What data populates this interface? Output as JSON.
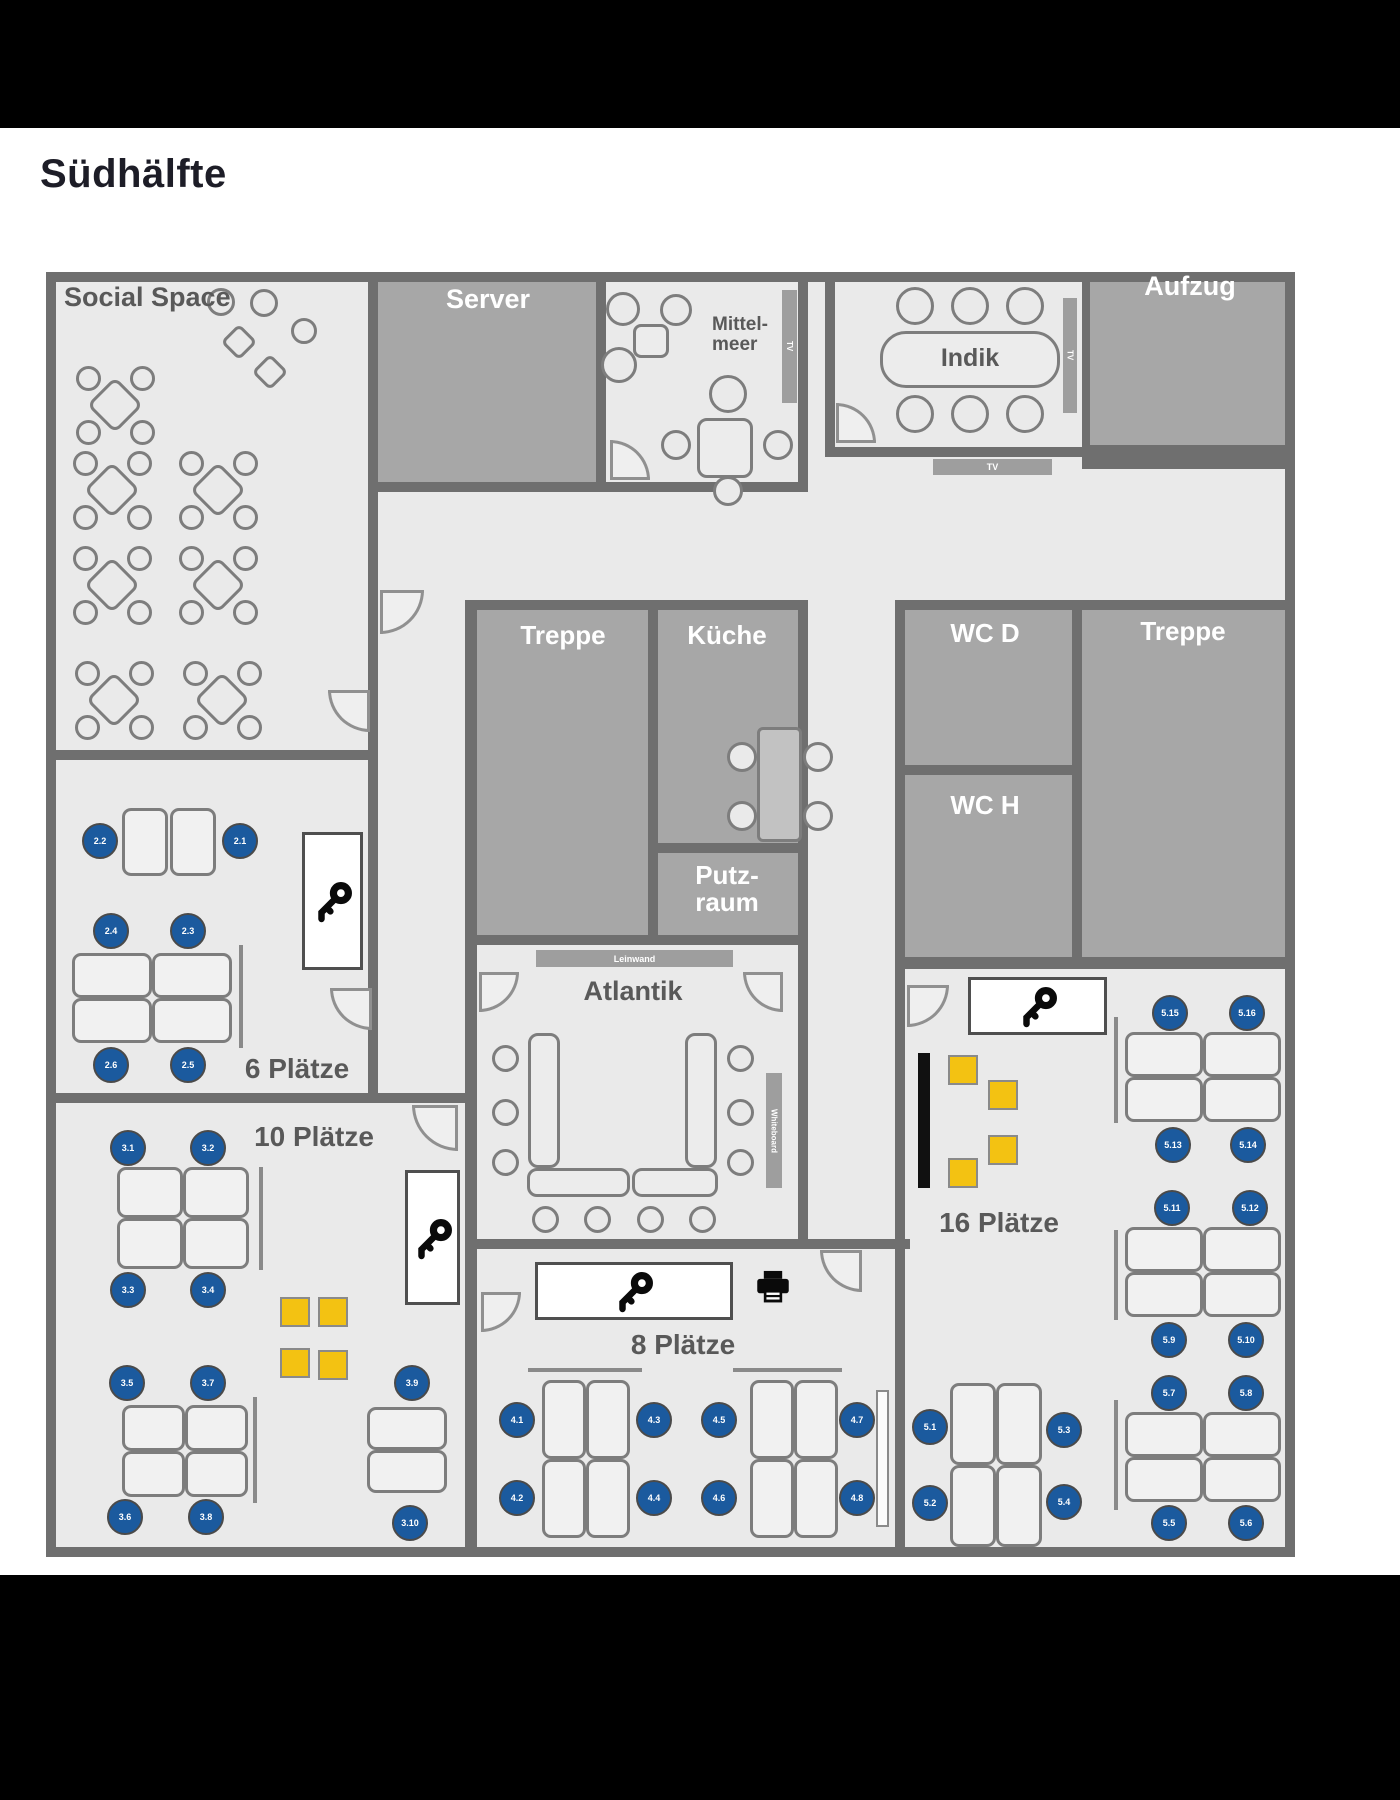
{
  "title": "Südhälfte",
  "colors": {
    "letterbox": "#000000",
    "floor": "#eaeaea",
    "wall": "#6f6f6f",
    "dark_room": "#a7a7a7",
    "seat_blue": "#1b5a9e",
    "locker_yellow": "#f3c212",
    "label_gray": "#595959",
    "label_white": "#ffffff"
  },
  "plan": {
    "rooms": [
      {
        "n": "floor",
        "x": 46,
        "y": 272,
        "w": 1249,
        "h": 1285,
        "f": "floor"
      },
      {
        "n": "server",
        "x": 378,
        "y": 282,
        "w": 218,
        "h": 200
      },
      {
        "n": "aufzug",
        "x": 1090,
        "y": 282,
        "w": 205,
        "h": 170
      },
      {
        "n": "treppe-mitte",
        "x": 477,
        "y": 610,
        "w": 171,
        "h": 330
      },
      {
        "n": "kueche",
        "x": 658,
        "y": 610,
        "w": 140,
        "h": 233
      },
      {
        "n": "putzraum",
        "x": 658,
        "y": 853,
        "w": 140,
        "h": 85
      },
      {
        "n": "wc-d",
        "x": 905,
        "y": 610,
        "w": 167,
        "h": 155
      },
      {
        "n": "wc-h",
        "x": 905,
        "y": 775,
        "w": 167,
        "h": 182
      },
      {
        "n": "treppe-rechts",
        "x": 1082,
        "y": 610,
        "w": 213,
        "h": 347
      }
    ],
    "walls": [
      [
        46,
        272,
        1249,
        10
      ],
      [
        46,
        272,
        10,
        1285
      ],
      [
        1285,
        272,
        10,
        1285
      ],
      [
        46,
        1547,
        1249,
        10
      ],
      [
        368,
        272,
        10,
        828
      ],
      [
        46,
        750,
        330,
        10
      ],
      [
        596,
        272,
        10,
        218
      ],
      [
        368,
        482,
        440,
        10
      ],
      [
        798,
        272,
        10,
        218
      ],
      [
        825,
        272,
        10,
        183
      ],
      [
        825,
        447,
        265,
        10
      ],
      [
        1082,
        272,
        8,
        183
      ],
      [
        1082,
        445,
        213,
        24
      ],
      [
        465,
        600,
        343,
        10
      ],
      [
        465,
        600,
        12,
        957
      ],
      [
        648,
        610,
        10,
        330
      ],
      [
        798,
        600,
        10,
        649
      ],
      [
        656,
        843,
        142,
        10
      ],
      [
        465,
        935,
        343,
        10
      ],
      [
        465,
        1239,
        445,
        10
      ],
      [
        895,
        600,
        10,
        957
      ],
      [
        895,
        600,
        400,
        10
      ],
      [
        903,
        765,
        170,
        10
      ],
      [
        1072,
        600,
        10,
        357
      ],
      [
        895,
        957,
        400,
        12
      ],
      [
        46,
        1093,
        424,
        10
      ]
    ],
    "doors": [
      {
        "x": 380,
        "y": 590,
        "s": 44,
        "c": "br"
      },
      {
        "x": 610,
        "y": 440,
        "s": 40,
        "c": "tr"
      },
      {
        "x": 836,
        "y": 403,
        "s": 40,
        "c": "tr"
      },
      {
        "x": 328,
        "y": 690,
        "s": 42,
        "c": "bl"
      },
      {
        "x": 330,
        "y": 988,
        "s": 42,
        "c": "bl"
      },
      {
        "x": 412,
        "y": 1105,
        "s": 46,
        "c": "bl"
      },
      {
        "x": 479,
        "y": 972,
        "s": 40,
        "c": "br"
      },
      {
        "x": 743,
        "y": 972,
        "s": 40,
        "c": "bl"
      },
      {
        "x": 481,
        "y": 1292,
        "s": 40,
        "c": "br"
      },
      {
        "x": 820,
        "y": 1250,
        "s": 42,
        "c": "bl"
      },
      {
        "x": 907,
        "y": 985,
        "s": 42,
        "c": "br"
      }
    ],
    "texts": [
      {
        "n": "label-social-space",
        "t": "Social Space",
        "x": 64,
        "y": 283,
        "s": 27
      },
      {
        "n": "label-server",
        "t": "Server",
        "cx": 488,
        "y": 285,
        "s": 27,
        "w": true
      },
      {
        "n": "label-mittelmeer",
        "t": "Mittel-\nmeer",
        "cx": 740,
        "y": 315,
        "s": 19
      },
      {
        "n": "label-indik",
        "t": "Indik",
        "cx": 970,
        "y": 345,
        "s": 25
      },
      {
        "n": "label-aufzug",
        "t": "Aufzug",
        "cx": 1190,
        "y": 272,
        "s": 27,
        "w": true
      },
      {
        "n": "label-treppe-mitte",
        "t": "Treppe",
        "cx": 563,
        "y": 622,
        "s": 26,
        "w": true
      },
      {
        "n": "label-kueche",
        "t": "Küche",
        "cx": 727,
        "y": 622,
        "s": 26,
        "w": true
      },
      {
        "n": "label-putzraum",
        "t": "Putz-\nraum",
        "cx": 727,
        "y": 862,
        "s": 26,
        "w": true
      },
      {
        "n": "label-wc-d",
        "t": "WC D",
        "cx": 985,
        "y": 620,
        "s": 26,
        "w": true
      },
      {
        "n": "label-wc-h",
        "t": "WC H",
        "cx": 985,
        "y": 792,
        "s": 26,
        "w": true
      },
      {
        "n": "label-treppe-rechts",
        "t": "Treppe",
        "cx": 1183,
        "y": 618,
        "s": 26,
        "w": true
      },
      {
        "n": "label-atlantik",
        "t": "Atlantik",
        "cx": 633,
        "y": 977,
        "s": 27
      },
      {
        "n": "label-6-plaetze",
        "t": "6 Plätze",
        "cx": 297,
        "y": 1054,
        "s": 28
      },
      {
        "n": "label-10-plaetze",
        "t": "10 Plätze",
        "cx": 314,
        "y": 1122,
        "s": 28
      },
      {
        "n": "label-8-plaetze",
        "t": "8 Plätze",
        "cx": 683,
        "y": 1330,
        "s": 28
      },
      {
        "n": "label-16-plaetze",
        "t": "16 Plätze",
        "cx": 999,
        "y": 1208,
        "s": 28
      }
    ],
    "signs": [
      {
        "n": "sign-leinwand",
        "t": "Leinwand",
        "x": 536,
        "y": 950,
        "w": 197,
        "h": 17
      },
      {
        "n": "sign-whiteboard",
        "t": "Whiteboard",
        "x": 766,
        "y": 1073,
        "w": 16,
        "h": 115,
        "rot": true
      },
      {
        "n": "sign-tv-mittelmeer",
        "t": "TV",
        "x": 782,
        "y": 290,
        "w": 15,
        "h": 113,
        "rot": true
      },
      {
        "n": "sign-tv-indik",
        "t": "TV",
        "x": 1063,
        "y": 298,
        "w": 14,
        "h": 115,
        "rot": true
      },
      {
        "n": "sign-tv-wand",
        "t": "TV",
        "x": 933,
        "y": 459,
        "w": 119,
        "h": 16
      }
    ],
    "round_tables": [
      {
        "cx": 115,
        "cy": 405
      },
      {
        "cx": 112,
        "cy": 490
      },
      {
        "cx": 218,
        "cy": 490
      },
      {
        "cx": 112,
        "cy": 585
      },
      {
        "cx": 218,
        "cy": 585
      },
      {
        "cx": 114,
        "cy": 700
      },
      {
        "cx": 222,
        "cy": 700
      }
    ],
    "social_shapes": [
      {
        "k": "circle",
        "cx": 221,
        "cy": 302,
        "d": 28
      },
      {
        "k": "circle",
        "cx": 264,
        "cy": 303,
        "d": 28
      },
      {
        "k": "diamond",
        "cx": 239,
        "cy": 342,
        "d": 26
      },
      {
        "k": "circle",
        "cx": 304,
        "cy": 331,
        "d": 26
      },
      {
        "k": "diamond",
        "cx": 270,
        "cy": 372,
        "d": 26
      }
    ],
    "tables": [
      {
        "x": 880,
        "y": 331,
        "w": 180,
        "h": 57,
        "r": 26
      },
      {
        "x": 697,
        "y": 418,
        "w": 56,
        "h": 60,
        "r": 10
      },
      {
        "x": 633,
        "y": 324,
        "w": 36,
        "h": 34,
        "r": 8
      },
      {
        "x": 757,
        "y": 727,
        "w": 45,
        "h": 115,
        "r": 6,
        "dark": true
      },
      {
        "x": 528,
        "y": 1033,
        "w": 32,
        "h": 135,
        "r": 10
      },
      {
        "x": 685,
        "y": 1033,
        "w": 32,
        "h": 135,
        "r": 10
      },
      {
        "x": 527,
        "y": 1168,
        "w": 103,
        "h": 29,
        "r": 10
      },
      {
        "x": 632,
        "y": 1168,
        "w": 86,
        "h": 29,
        "r": 10
      }
    ],
    "chairs": [
      {
        "cx": 623,
        "cy": 309,
        "d": 34
      },
      {
        "cx": 676,
        "cy": 310,
        "d": 32
      },
      {
        "cx": 619,
        "cy": 365,
        "d": 36
      },
      {
        "cx": 728,
        "cy": 394,
        "d": 38
      },
      {
        "cx": 676,
        "cy": 445,
        "d": 30
      },
      {
        "cx": 778,
        "cy": 445,
        "d": 30
      },
      {
        "cx": 728,
        "cy": 491,
        "d": 30
      },
      {
        "cx": 915,
        "cy": 306,
        "d": 38
      },
      {
        "cx": 970,
        "cy": 306,
        "d": 38
      },
      {
        "cx": 1025,
        "cy": 306,
        "d": 38
      },
      {
        "cx": 915,
        "cy": 414,
        "d": 38
      },
      {
        "cx": 970,
        "cy": 414,
        "d": 38
      },
      {
        "cx": 1025,
        "cy": 414,
        "d": 38
      },
      {
        "cx": 742,
        "cy": 757,
        "d": 30
      },
      {
        "cx": 742,
        "cy": 816,
        "d": 30
      },
      {
        "cx": 818,
        "cy": 757,
        "d": 30
      },
      {
        "cx": 818,
        "cy": 816,
        "d": 30
      },
      {
        "cx": 505,
        "cy": 1058,
        "d": 27
      },
      {
        "cx": 505,
        "cy": 1112,
        "d": 27
      },
      {
        "cx": 505,
        "cy": 1162,
        "d": 27
      },
      {
        "cx": 740,
        "cy": 1058,
        "d": 27
      },
      {
        "cx": 740,
        "cy": 1112,
        "d": 27
      },
      {
        "cx": 740,
        "cy": 1162,
        "d": 27
      },
      {
        "cx": 545,
        "cy": 1219,
        "d": 27
      },
      {
        "cx": 597,
        "cy": 1219,
        "d": 27
      },
      {
        "cx": 650,
        "cy": 1219,
        "d": 27
      },
      {
        "cx": 702,
        "cy": 1219,
        "d": 27
      }
    ],
    "desks": [
      [
        122,
        808,
        46,
        68
      ],
      [
        170,
        808,
        46,
        68
      ],
      [
        72,
        953,
        80,
        45
      ],
      [
        152,
        953,
        80,
        45
      ],
      [
        72,
        998,
        80,
        45
      ],
      [
        152,
        998,
        80,
        45
      ],
      [
        117,
        1167,
        66,
        51
      ],
      [
        183,
        1167,
        66,
        51
      ],
      [
        117,
        1218,
        66,
        51
      ],
      [
        183,
        1218,
        66,
        51
      ],
      [
        122,
        1405,
        63,
        46
      ],
      [
        185,
        1405,
        63,
        46
      ],
      [
        122,
        1451,
        63,
        46
      ],
      [
        185,
        1451,
        63,
        46
      ],
      [
        367,
        1407,
        80,
        43
      ],
      [
        367,
        1450,
        80,
        43
      ],
      [
        542,
        1380,
        44,
        79
      ],
      [
        586,
        1380,
        44,
        79
      ],
      [
        542,
        1459,
        44,
        79
      ],
      [
        586,
        1459,
        44,
        79
      ],
      [
        750,
        1380,
        44,
        79
      ],
      [
        794,
        1380,
        44,
        79
      ],
      [
        750,
        1459,
        44,
        79
      ],
      [
        794,
        1459,
        44,
        79
      ],
      [
        950,
        1383,
        46,
        82
      ],
      [
        996,
        1383,
        46,
        82
      ],
      [
        950,
        1465,
        46,
        82
      ],
      [
        996,
        1465,
        46,
        82
      ],
      [
        1125,
        1032,
        78,
        45
      ],
      [
        1203,
        1032,
        78,
        45
      ],
      [
        1125,
        1077,
        78,
        45
      ],
      [
        1203,
        1077,
        78,
        45
      ],
      [
        1125,
        1227,
        78,
        45
      ],
      [
        1203,
        1227,
        78,
        45
      ],
      [
        1125,
        1272,
        78,
        45
      ],
      [
        1203,
        1272,
        78,
        45
      ],
      [
        1125,
        1412,
        78,
        45
      ],
      [
        1203,
        1412,
        78,
        45
      ],
      [
        1125,
        1457,
        78,
        45
      ],
      [
        1203,
        1457,
        78,
        45
      ]
    ],
    "seats": [
      {
        "label": "2.2",
        "cx": 100,
        "cy": 841
      },
      {
        "label": "2.1",
        "cx": 240,
        "cy": 841
      },
      {
        "label": "2.4",
        "cx": 111,
        "cy": 931
      },
      {
        "label": "2.3",
        "cx": 188,
        "cy": 931
      },
      {
        "label": "2.6",
        "cx": 111,
        "cy": 1065
      },
      {
        "label": "2.5",
        "cx": 188,
        "cy": 1065
      },
      {
        "label": "3.1",
        "cx": 128,
        "cy": 1148
      },
      {
        "label": "3.2",
        "cx": 208,
        "cy": 1148
      },
      {
        "label": "3.3",
        "cx": 128,
        "cy": 1290
      },
      {
        "label": "3.4",
        "cx": 208,
        "cy": 1290
      },
      {
        "label": "3.5",
        "cx": 127,
        "cy": 1383
      },
      {
        "label": "3.7",
        "cx": 208,
        "cy": 1383
      },
      {
        "label": "3.6",
        "cx": 125,
        "cy": 1517
      },
      {
        "label": "3.8",
        "cx": 206,
        "cy": 1517
      },
      {
        "label": "3.9",
        "cx": 412,
        "cy": 1383
      },
      {
        "label": "3.10",
        "cx": 410,
        "cy": 1523
      },
      {
        "label": "4.1",
        "cx": 517,
        "cy": 1420
      },
      {
        "label": "4.3",
        "cx": 654,
        "cy": 1420
      },
      {
        "label": "4.2",
        "cx": 517,
        "cy": 1498
      },
      {
        "label": "4.4",
        "cx": 654,
        "cy": 1498
      },
      {
        "label": "4.5",
        "cx": 719,
        "cy": 1420
      },
      {
        "label": "4.7",
        "cx": 857,
        "cy": 1420
      },
      {
        "label": "4.6",
        "cx": 719,
        "cy": 1498
      },
      {
        "label": "4.8",
        "cx": 857,
        "cy": 1498
      },
      {
        "label": "5.1",
        "cx": 930,
        "cy": 1427
      },
      {
        "label": "5.3",
        "cx": 1064,
        "cy": 1430
      },
      {
        "label": "5.2",
        "cx": 930,
        "cy": 1503
      },
      {
        "label": "5.4",
        "cx": 1064,
        "cy": 1502
      },
      {
        "label": "5.15",
        "cx": 1170,
        "cy": 1013
      },
      {
        "label": "5.16",
        "cx": 1247,
        "cy": 1013
      },
      {
        "label": "5.13",
        "cx": 1173,
        "cy": 1145
      },
      {
        "label": "5.14",
        "cx": 1248,
        "cy": 1145
      },
      {
        "label": "5.11",
        "cx": 1172,
        "cy": 1208
      },
      {
        "label": "5.12",
        "cx": 1250,
        "cy": 1208
      },
      {
        "label": "5.9",
        "cx": 1169,
        "cy": 1340
      },
      {
        "label": "5.10",
        "cx": 1246,
        "cy": 1340
      },
      {
        "label": "5.7",
        "cx": 1169,
        "cy": 1393
      },
      {
        "label": "5.8",
        "cx": 1246,
        "cy": 1393
      },
      {
        "label": "5.5",
        "cx": 1169,
        "cy": 1523
      },
      {
        "label": "5.6",
        "cx": 1246,
        "cy": 1523
      }
    ],
    "lockers": [
      [
        280,
        1297,
        30
      ],
      [
        318,
        1297,
        30
      ],
      [
        280,
        1348,
        30
      ],
      [
        318,
        1350,
        30
      ],
      [
        948,
        1055,
        30
      ],
      [
        988,
        1080,
        30
      ],
      [
        988,
        1135,
        30
      ],
      [
        948,
        1158,
        30
      ]
    ],
    "keyboxes": [
      {
        "x": 302,
        "y": 832,
        "w": 61,
        "h": 138
      },
      {
        "x": 405,
        "y": 1170,
        "w": 55,
        "h": 135
      },
      {
        "x": 535,
        "y": 1262,
        "w": 198,
        "h": 58
      },
      {
        "x": 968,
        "y": 977,
        "w": 139,
        "h": 58
      }
    ],
    "printer": {
      "x": 750,
      "y": 1266,
      "w": 46,
      "h": 44
    },
    "blackbars": [
      [
        918,
        1053,
        12,
        135
      ]
    ],
    "whitebars": [
      [
        876,
        1390,
        13,
        137
      ]
    ],
    "dividers": [
      [
        239,
        945,
        4,
        103
      ],
      [
        259,
        1167,
        4,
        103
      ],
      [
        253,
        1397,
        4,
        106
      ],
      [
        528,
        1368,
        114,
        4
      ],
      [
        733,
        1368,
        109,
        4
      ],
      [
        1114,
        1017,
        4,
        106
      ],
      [
        1114,
        1230,
        4,
        90
      ],
      [
        1114,
        1400,
        4,
        110
      ]
    ]
  }
}
